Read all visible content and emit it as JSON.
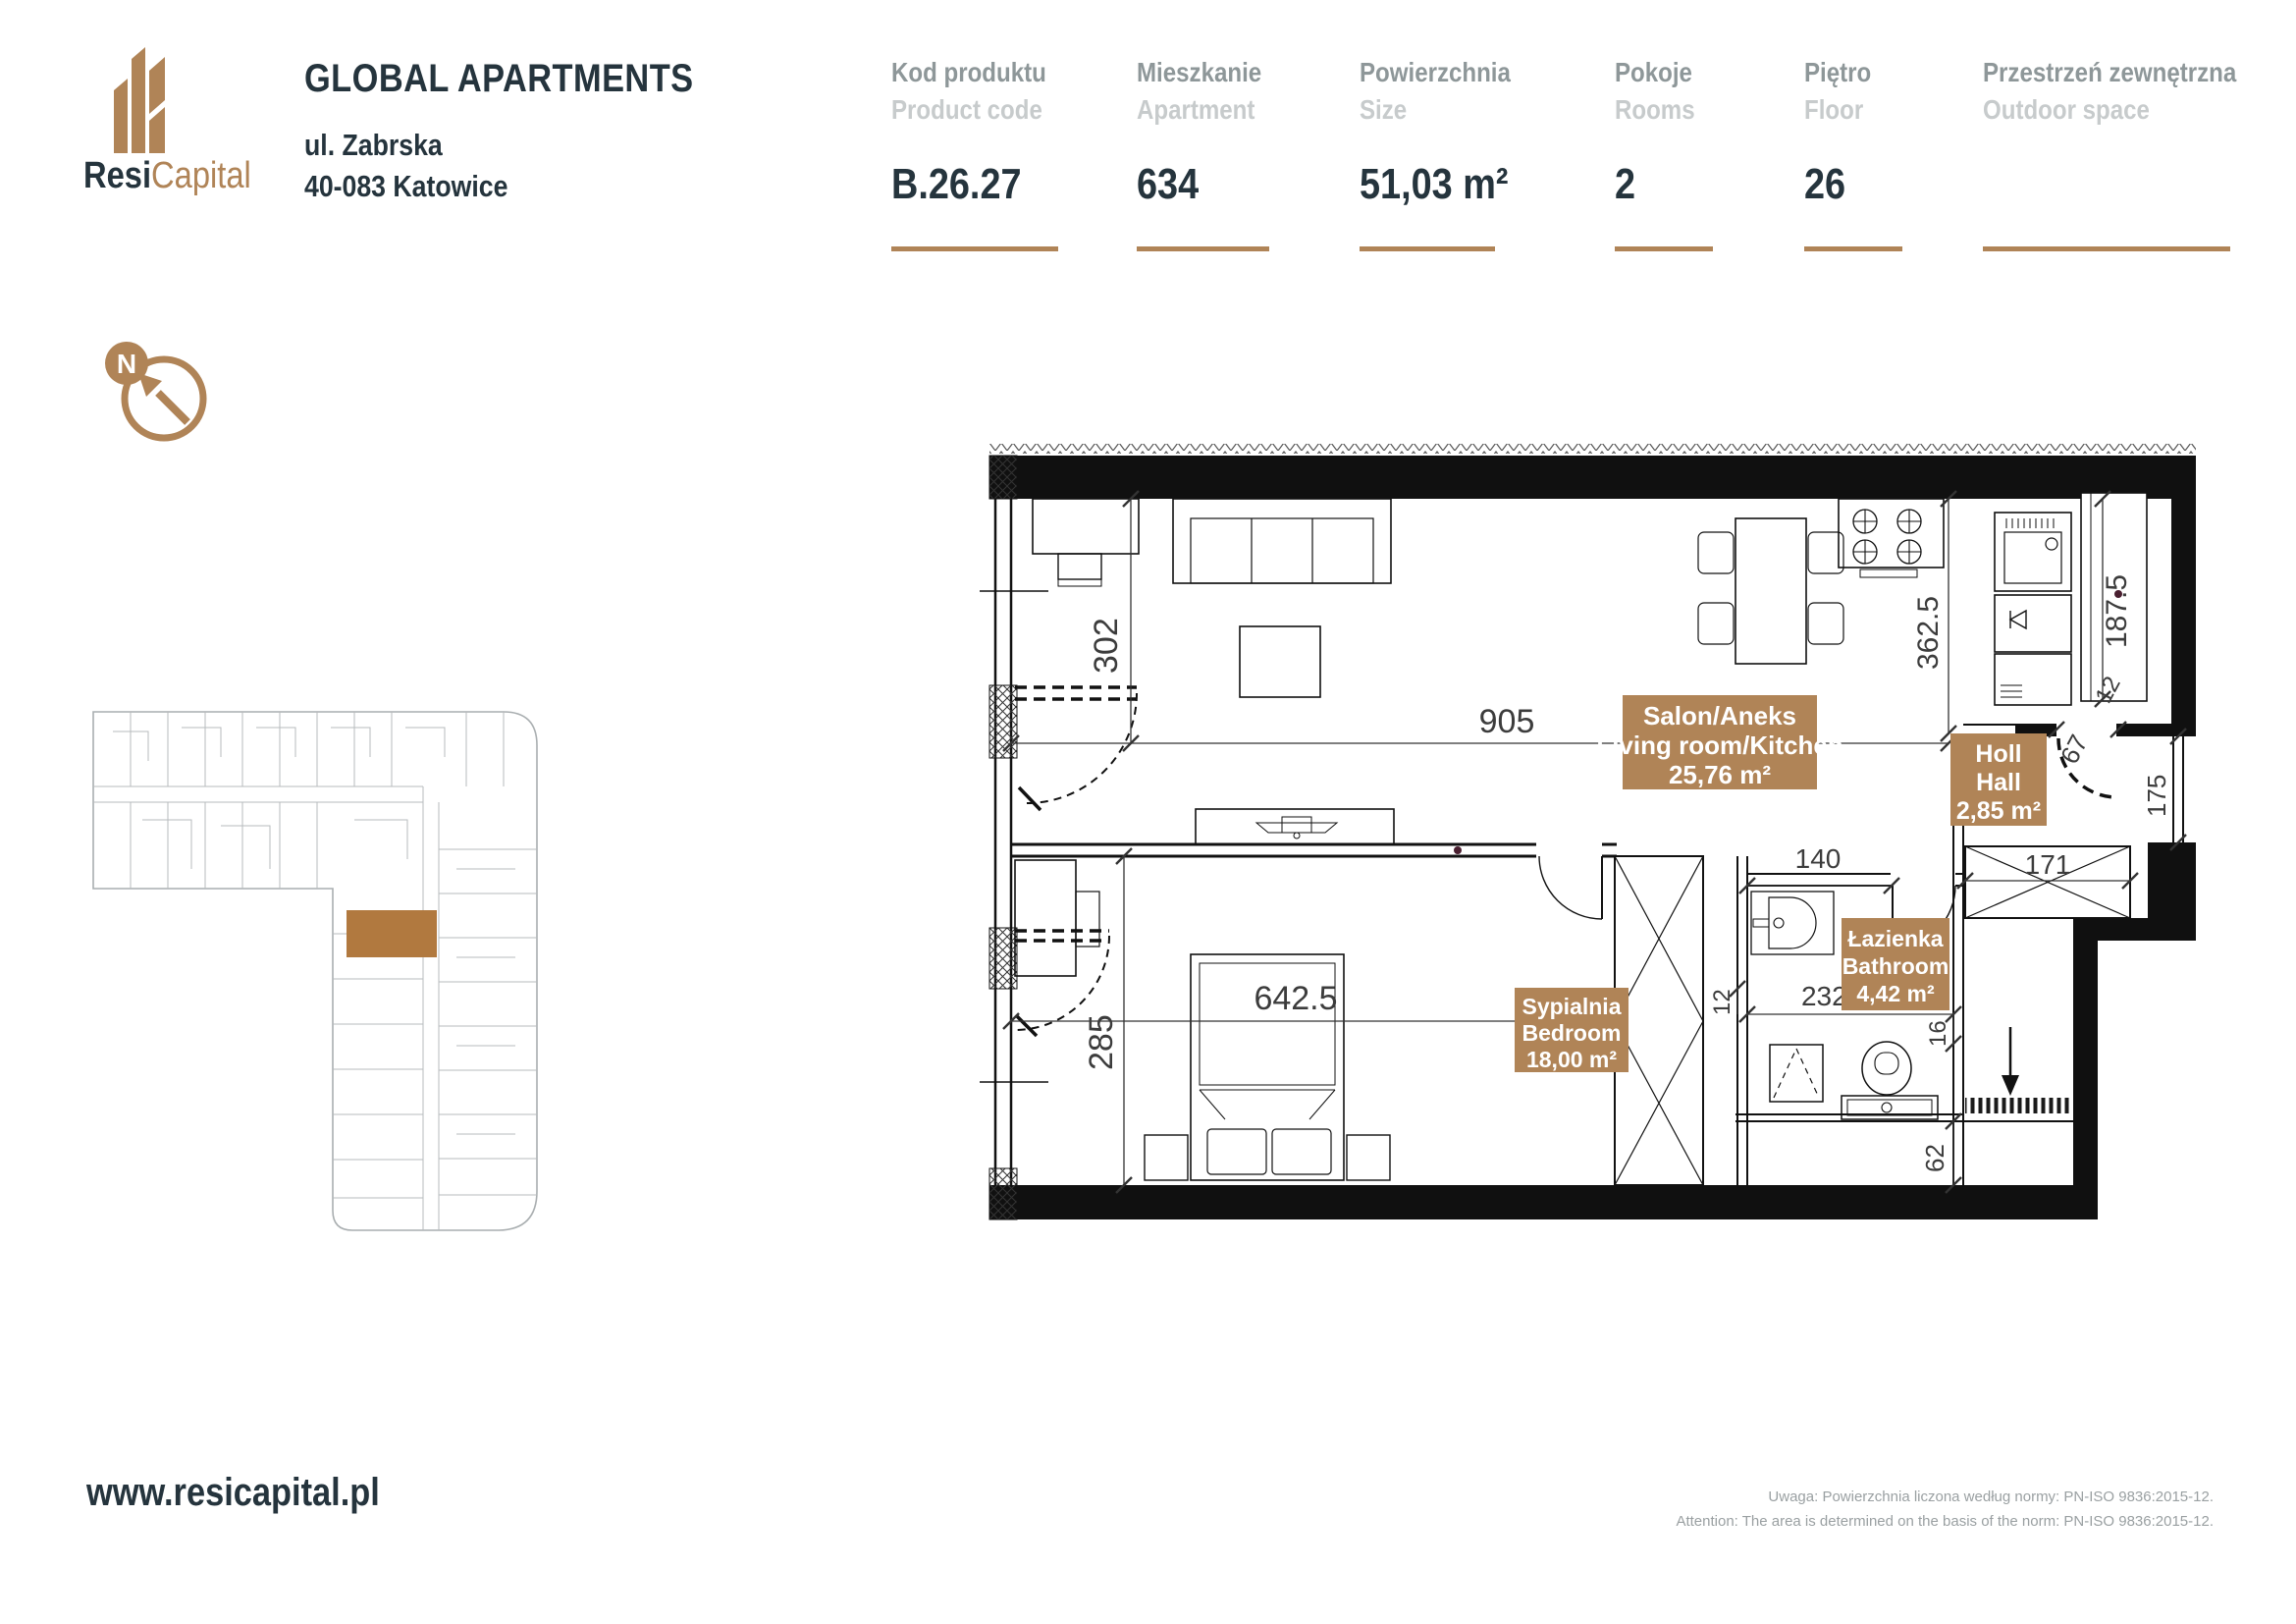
{
  "brand": {
    "name_primary": "Resi",
    "name_secondary": "Capital",
    "logo_icon": "buildings-icon"
  },
  "project": {
    "title": "GLOBAL APARTMENTS",
    "address_line1": "ul. Zabrska",
    "address_line2": "40-083 Katowice"
  },
  "specs": [
    {
      "label_pl": "Kod produktu",
      "label_en": "Product code",
      "value": "B.26.27"
    },
    {
      "label_pl": "Mieszkanie",
      "label_en": "Apartment",
      "value": "634"
    },
    {
      "label_pl": "Powierzchnia",
      "label_en": "Size",
      "value": "51,03 m²"
    },
    {
      "label_pl": "Pokoje",
      "label_en": "Rooms",
      "value": "2"
    },
    {
      "label_pl": "Piętro",
      "label_en": "Floor",
      "value": "26"
    },
    {
      "label_pl": "Przestrzeń zewnętrzna",
      "label_en": "Outdoor space",
      "value": ""
    }
  ],
  "compass": {
    "north_label": "N"
  },
  "rooms": [
    {
      "name_pl": "Salon/Aneks",
      "name_en": "Living room/Kitchen",
      "area": "25,76 m²"
    },
    {
      "name_pl": "Holl",
      "name_en": "Hall",
      "area": "2,85 m²"
    },
    {
      "name_pl": "Sypialnia",
      "name_en": "Bedroom",
      "area": "18,00 m²"
    },
    {
      "name_pl": "Łazienka",
      "name_en": "Bathroom",
      "area": "4,42 m²"
    }
  ],
  "dims": {
    "living_depth": "302",
    "living_width": "905",
    "bedroom_depth": "285",
    "bedroom_width": "642.5",
    "kitchen_depth": "362.5",
    "counter_len": "187.5",
    "hall_side": "175",
    "shaft_width": "171",
    "bath_left": "140",
    "bath_width": "232.5",
    "bath_nib": "16",
    "bottom_zone": "62",
    "wall_a": "12",
    "wall_b": "12",
    "entry_door": "67"
  },
  "footer": {
    "website": "www.resicapital.pl",
    "note_pl": "Uwaga: Powierzchnia liczona według normy: PN-ISO 9836:2015-12.",
    "note_en": "Attention: The area is determined on the basis of the norm: PN-ISO 9836:2015-12."
  },
  "colors": {
    "accent_tan": "#b08457",
    "navy": "#25343d",
    "label_gray": "#8e9799",
    "label_light_gray": "#c7cbcc",
    "unit_highlight": "#b1793f"
  }
}
